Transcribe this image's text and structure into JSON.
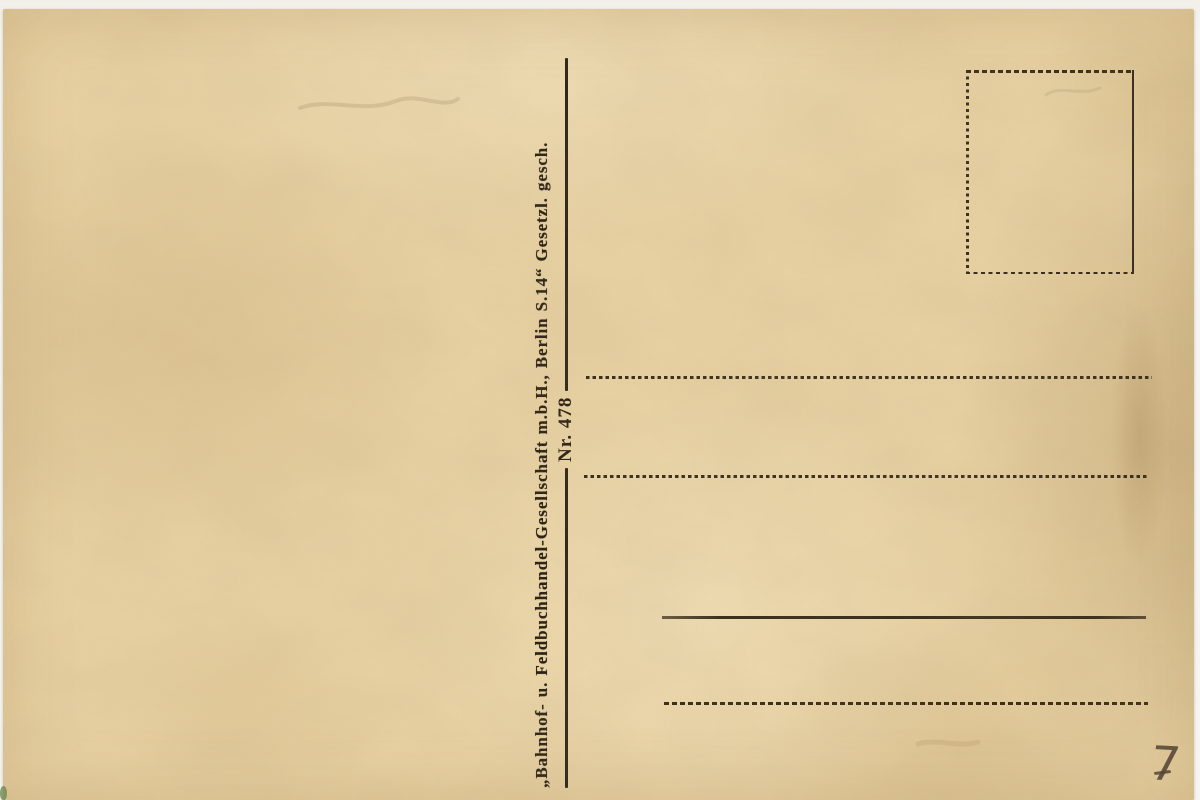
{
  "postcard": {
    "publisher_imprint": "„Bahnhof- u. Feldbuchhandel-Gesellschaft m.b.H., Berlin S.14“ Gesetzl. gesch.",
    "series_label": "Nr. 478",
    "handwritten_number": "7",
    "colors": {
      "paper": "#e9d2a3",
      "ink": "#2b2014",
      "pencil": "#4e4030",
      "speck_green": "#6d8a52"
    }
  }
}
